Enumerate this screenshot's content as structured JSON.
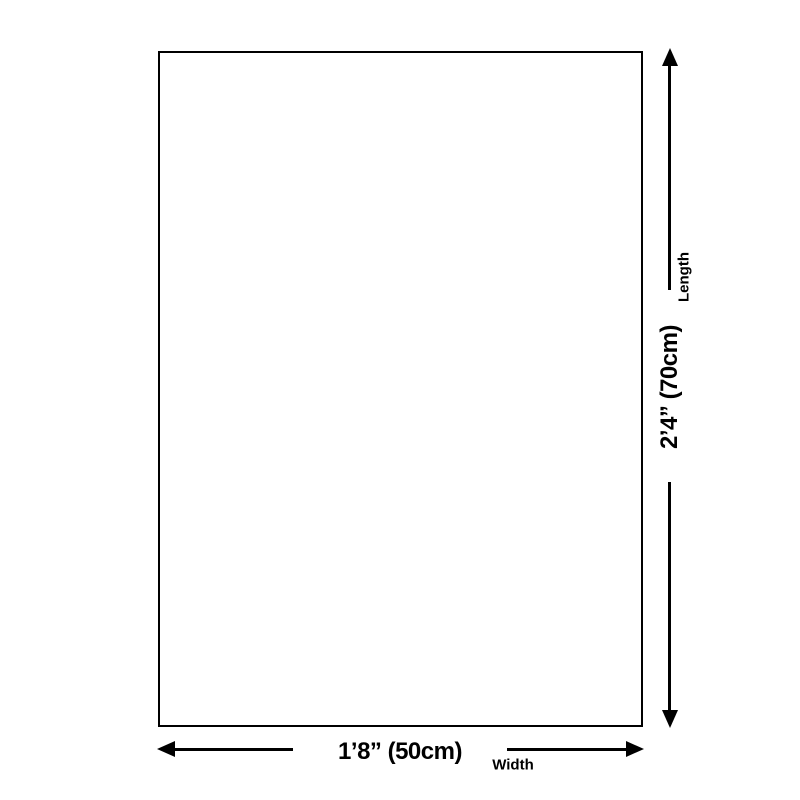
{
  "diagram": {
    "width": {
      "dimension": "1’8” (50cm)",
      "label": "Width"
    },
    "length": {
      "dimension": "2’4” (70cm)",
      "label": "Length"
    },
    "colors": {
      "line": "#000000",
      "background": "#ffffff"
    }
  }
}
